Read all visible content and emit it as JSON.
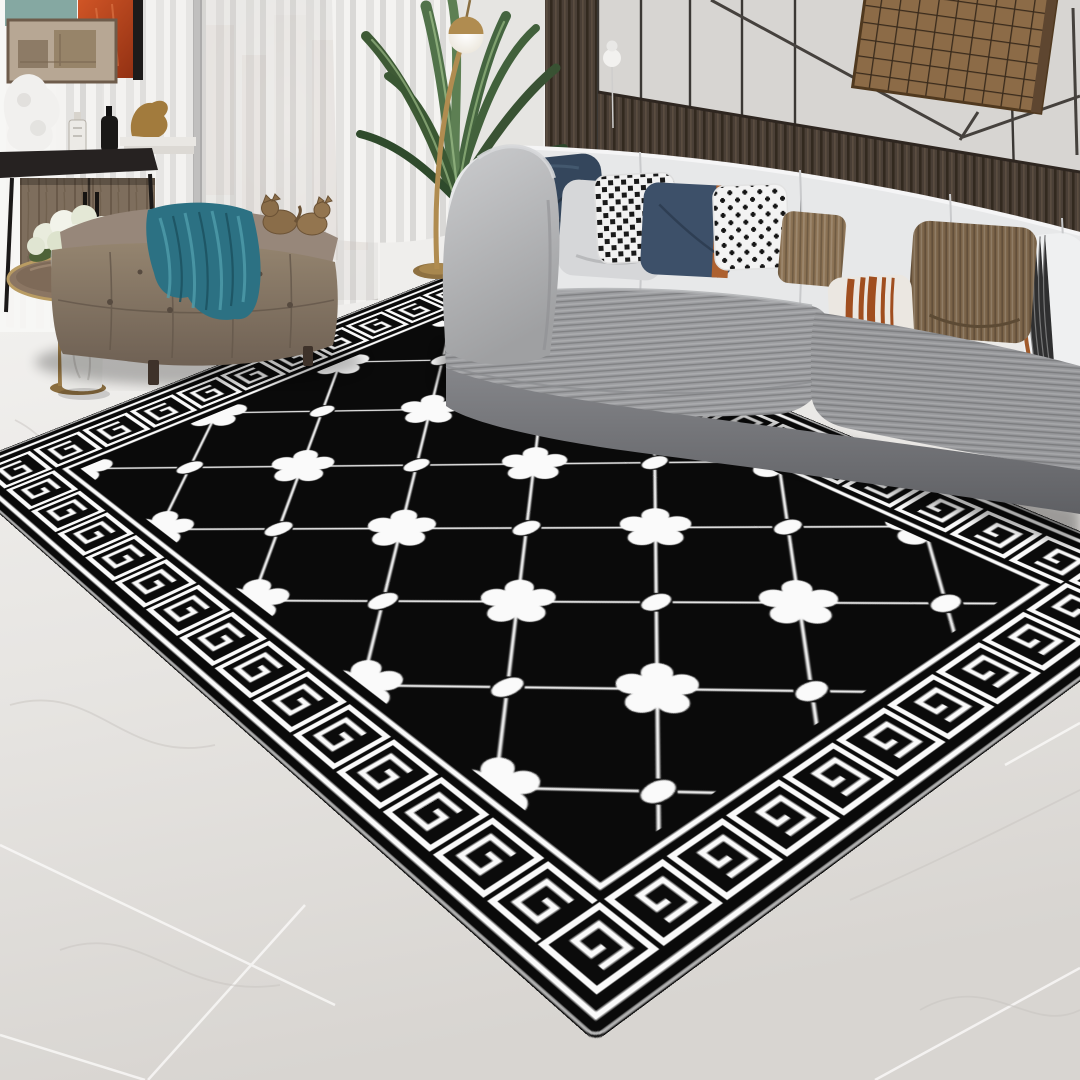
{
  "scene": {
    "caption": "Modern living room product photo: a large black area rug with a white Greek-key meander border and a diagonal lattice of five-petal flowers and dots, laid on a light marble tile floor in front of a curved gray velvet sofa, a tufted taupe ottoman with a teal throw, a black console with abstract art, a round brass side table with white hydrangeas, a palm plant and a brass globe floor lamp, with sheer curtains and dark wood-slat wall panels."
  },
  "rug": {
    "shape": "rectangle",
    "style": "modern greek-key",
    "field_color": "#0a0a0a",
    "motif_color": "#fafafa",
    "edge_color": "#d9d9d9",
    "border": "double white bands with white Greek-key meander tiles on black",
    "field_pattern": "diagonal diamond lattice with alternating five-petal flowers and oval dots at intersections"
  },
  "palette": {
    "floor_marble": "#e9e7e4",
    "wall_panel": "#d7d5d2",
    "slat_wood": "#4a3f36",
    "curtain": "#f2f1ef",
    "sofa_gray": "#9c9da0",
    "sofa_back": "#e7e8e9",
    "sofa_arm": "#c0c1c3",
    "ottoman_taupe": "#97877a",
    "throw_teal": "#2c7183",
    "accent_orange": "#ad6130",
    "brass_gold": "#b08c50",
    "plant_green": "#49693f",
    "art_brown": "#8c6b47",
    "art_orange": "#c64a1e",
    "art_teal": "#85a8a2"
  },
  "pillows": [
    {
      "label": "dark navy velvet pillow",
      "color": "#34465c"
    },
    {
      "label": "light gray velvet pillow",
      "color": "#d6d7d9"
    },
    {
      "label": "black and white dotted pillow",
      "color": "#f1f1f1"
    },
    {
      "label": "navy pillow with leather strap",
      "color": "#3d5069"
    },
    {
      "label": "black and white cross pillow",
      "color": "#f3f3f3"
    },
    {
      "label": "brown corduroy pillow",
      "color": "#8b7254"
    },
    {
      "label": "ivory pillow with rust stripes",
      "color": "#ebe7e1"
    },
    {
      "label": "dark brown corduroy pillow",
      "color": "#7a6348"
    },
    {
      "label": "white striped bolster pillow",
      "color": "#eff0f1"
    }
  ],
  "objects": [
    {
      "label": "curved gray velvet sofa"
    },
    {
      "label": "tufted taupe ottoman bench"
    },
    {
      "label": "teal velvet throw blanket"
    },
    {
      "label": "brass cat figurines"
    },
    {
      "label": "round brass side table"
    },
    {
      "label": "white hydrangea bouquet in glass vase"
    },
    {
      "label": "white marble cylinder vase"
    },
    {
      "label": "black console table with artwork"
    },
    {
      "label": "brown grid wall art"
    },
    {
      "label": "palm houseplant"
    },
    {
      "label": "brass globe floor lamp"
    },
    {
      "label": "sheer white curtains"
    },
    {
      "label": "marble tile floor"
    },
    {
      "label": "black greek-key area rug"
    }
  ]
}
